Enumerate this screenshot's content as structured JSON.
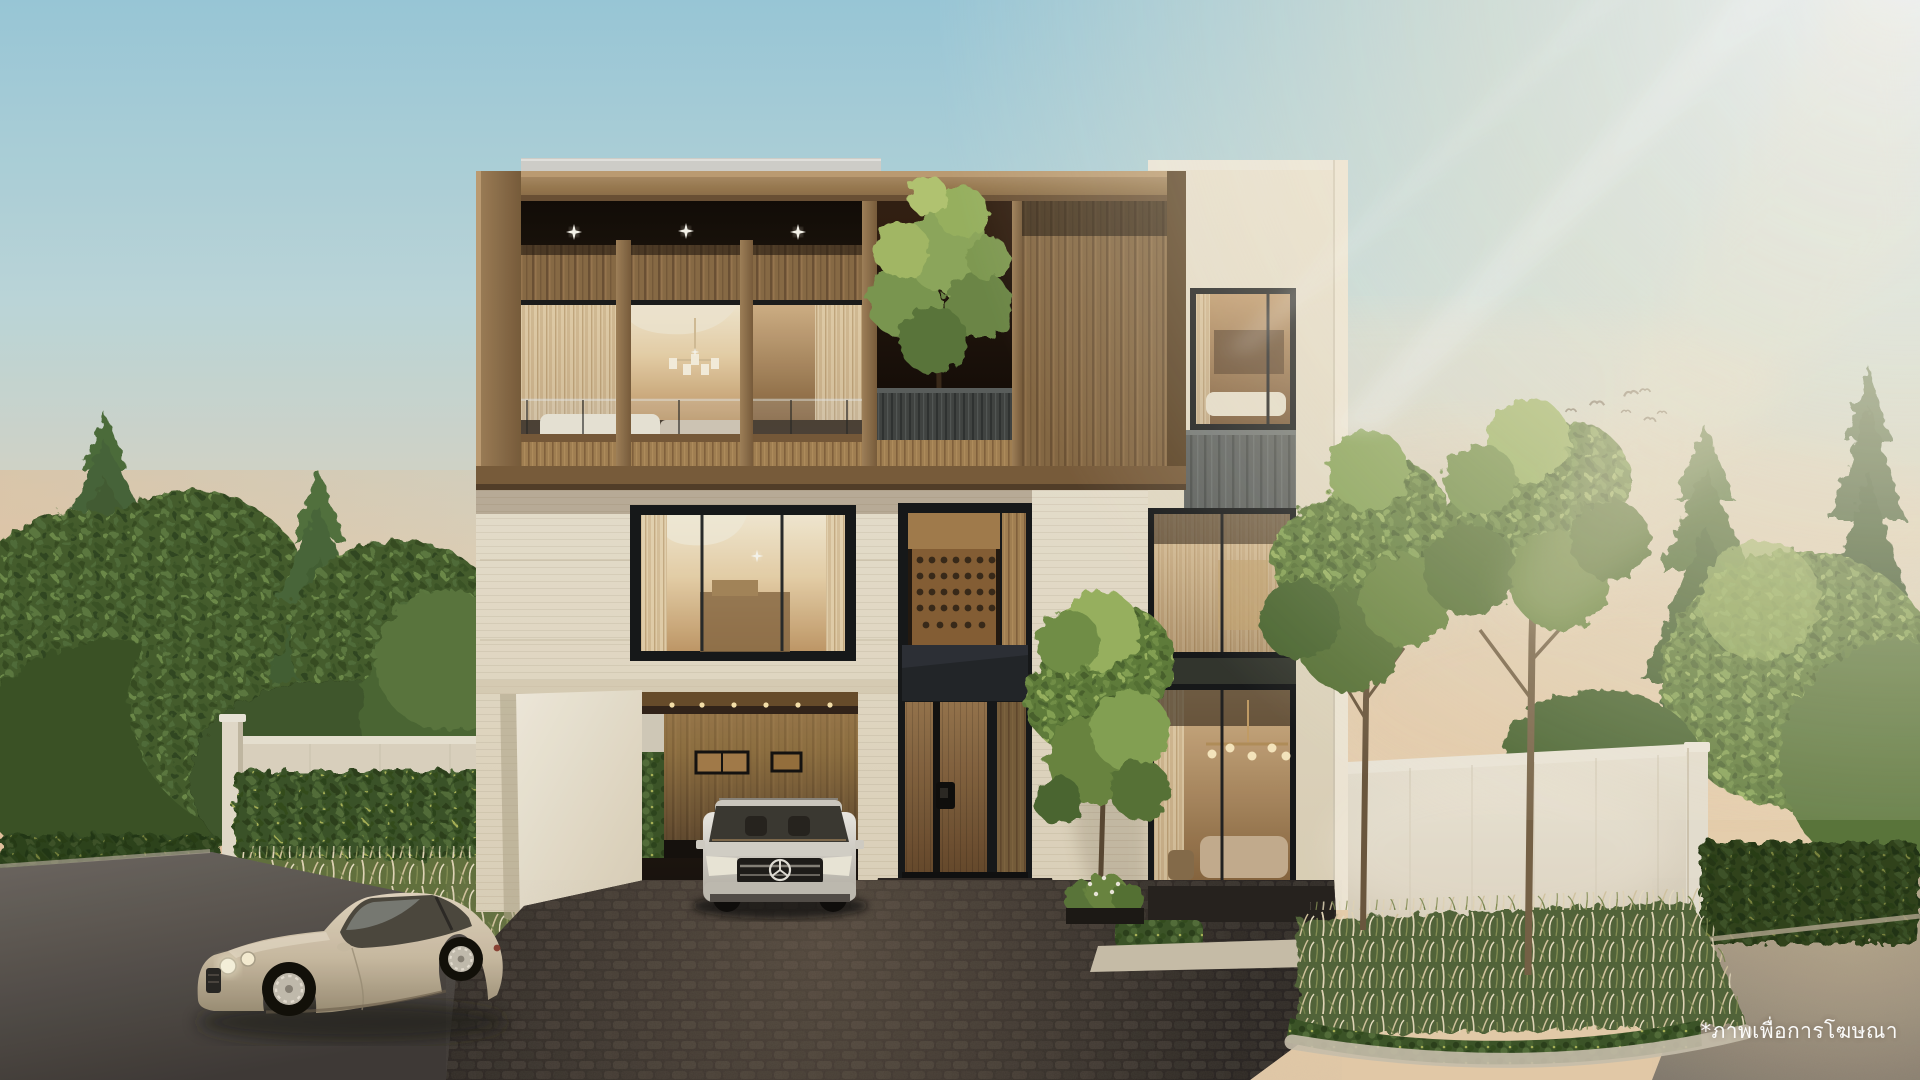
{
  "scene": {
    "description": "Photorealistic dusk rendering of a modern three-storey luxury house with a timber-clad top floor, cream facade, glass tower wing, carport with a white SUV, and a champagne coupe parked on the street",
    "objects": [
      {
        "name": "wood-facade-box",
        "label": "timber-clad upper floor with balcony and recessed downlights"
      },
      {
        "name": "rooftop-courtyard-tree",
        "label": "tree growing through a roof opening"
      },
      {
        "name": "glass-tower-wing",
        "label": "right wing with three stacked floor-to-ceiling windows"
      },
      {
        "name": "wine-cellar-window",
        "label": "tall entry window showing a wine rack"
      },
      {
        "name": "entry-door",
        "label": "wooden front door with digital lock"
      },
      {
        "name": "carport",
        "label": "covered carport with wood-slat wall and downlights"
      },
      {
        "name": "mercedes-suv",
        "label": "white SUV parked in carport"
      },
      {
        "name": "bentley-coupe",
        "label": "champagne coupe parked on street"
      },
      {
        "name": "boundary-walls",
        "label": "white perimeter walls with hedges"
      },
      {
        "name": "pampas-grass",
        "label": "feathery ornamental grass beds"
      },
      {
        "name": "bird-flock",
        "label": "flock of birds in sunset sky"
      },
      {
        "name": "sun-rays",
        "label": "light rays from top right"
      }
    ]
  },
  "watermark": {
    "text": "*ภาพเพื่อการโฆษณา",
    "language": "th",
    "color": "#ffffff"
  },
  "palette": {
    "sky_top": "#9fcfe0",
    "sky_horizon": "#f1d6b2",
    "sun_glow": "#fff6e0",
    "wood_frame": "#a08055",
    "wood_slat_dark": "#6f5436",
    "soffit_shadow": "#1a120a",
    "facade_cream": "#efe7d4",
    "window_frame_black": "#17191a",
    "interior_warm": "#eed7ae",
    "tower_slat_gray": "#5f6361",
    "foliage_dark": "#46602f",
    "foliage_warm": "#74944a",
    "cobble_dark": "#2b2622",
    "asphalt": "#6e6861",
    "car_champagne": "#d6c8ae"
  }
}
